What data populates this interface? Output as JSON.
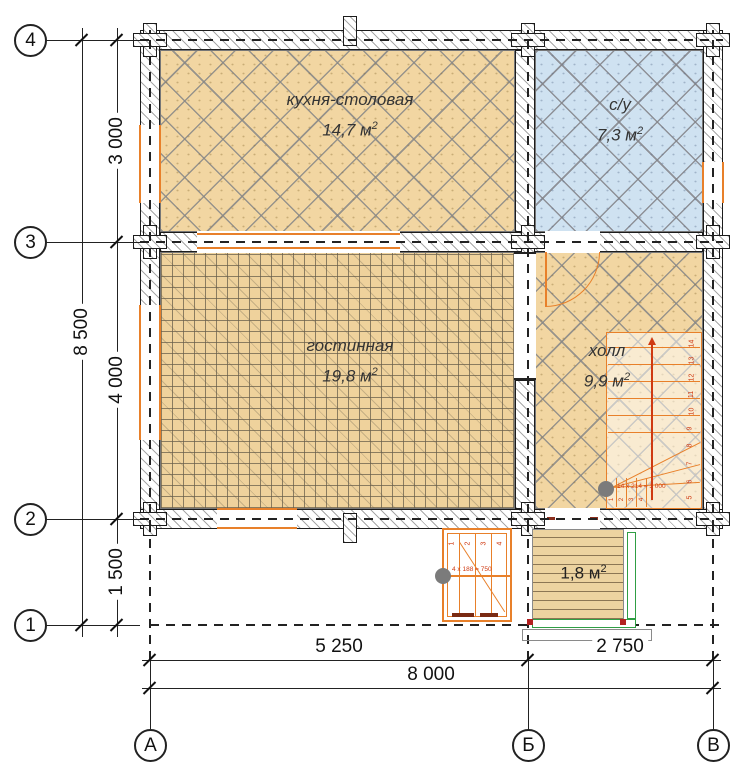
{
  "plan": {
    "rooms": [
      {
        "label": "кухня-столовая",
        "area": "14,7 м",
        "sup": "2"
      },
      {
        "label": "с/у",
        "area": "7,3 м",
        "sup": "2"
      },
      {
        "label": "гостинная",
        "area": "19,8 м",
        "sup": "2"
      },
      {
        "label": "холл",
        "area": "9,9 м",
        "sup": "2"
      },
      {
        "area": "1,8 м",
        "sup": "2"
      }
    ],
    "axes": {
      "rows": [
        "4",
        "3",
        "2",
        "1"
      ],
      "cols": [
        "А",
        "Б",
        "В"
      ]
    },
    "dimensions": {
      "left_total": "8 500",
      "left_segments": [
        "3 000",
        "4 000",
        "1 500"
      ],
      "bottom_segments": [
        "5 250",
        "2 750"
      ],
      "bottom_total": "8 000"
    },
    "stairs": {
      "internal": {
        "formula": "14 х 214 = 3 000",
        "step_numbers": [
          "14",
          "13",
          "12",
          "11",
          "10",
          "9",
          "8",
          "7",
          "6",
          "5"
        ],
        "winder_numbers": [
          "1",
          "2",
          "3",
          "4"
        ]
      },
      "external": {
        "formula": "4 х 188 = 750",
        "step_numbers": [
          "1",
          "2",
          "3",
          "4"
        ]
      }
    },
    "colors": {
      "floor_wood": "#f2d6a2",
      "floor_blue": "#cfe2f1",
      "joinery_orange": "#e8802a",
      "annotation_red": "#cf3a12",
      "railing_green": "#2f9e44",
      "newel_gray": "#7b7b7b"
    }
  }
}
